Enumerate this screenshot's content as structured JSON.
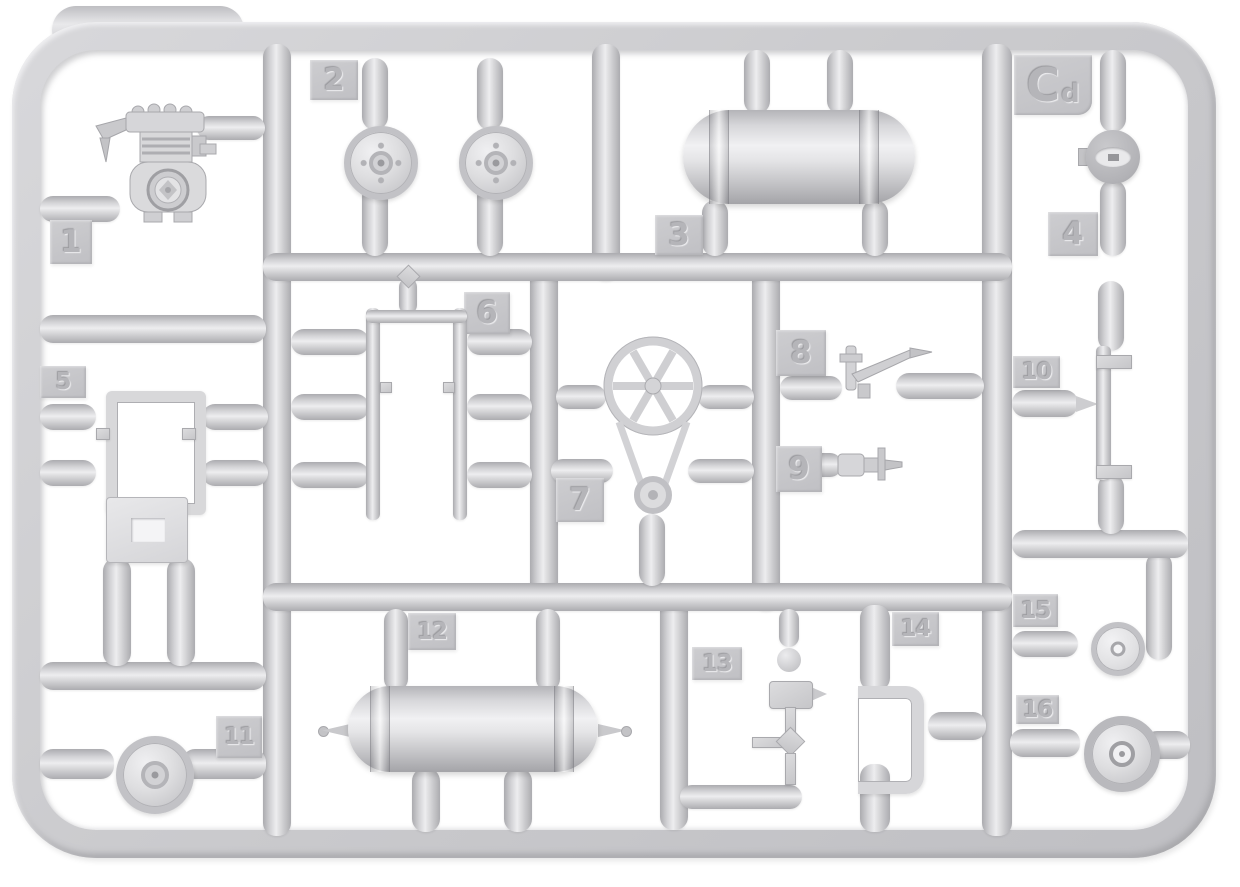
{
  "sprue": {
    "code": {
      "main": "C",
      "sub": "d"
    },
    "colors": {
      "plastic": "#c9c9cc",
      "plastic_light": "#ececee",
      "plastic_dark": "#aaaaae",
      "background": "#ffffff"
    },
    "parts": [
      {
        "number": "1",
        "shape": "air-compressor"
      },
      {
        "number": "2",
        "shape": "round-hatch-wheel-pair"
      },
      {
        "number": "3",
        "shape": "cylindrical-air-tank"
      },
      {
        "number": "4",
        "shape": "headlight"
      },
      {
        "number": "5",
        "shape": "mount-bracket-and-plate"
      },
      {
        "number": "6",
        "shape": "ladder-frame"
      },
      {
        "number": "7",
        "shape": "fan-wheel-with-belt-pulley"
      },
      {
        "number": "8",
        "shape": "valve-with-lever"
      },
      {
        "number": "9",
        "shape": "small-valve"
      },
      {
        "number": "10",
        "shape": "z-bracket"
      },
      {
        "number": "11",
        "shape": "pulley-wheel"
      },
      {
        "number": "12",
        "shape": "tank-with-axle-tips"
      },
      {
        "number": "13",
        "shape": "valve-pipe-assembly"
      },
      {
        "number": "14",
        "shape": "u-channel-bracket"
      },
      {
        "number": "15",
        "shape": "small-pulley"
      },
      {
        "number": "16",
        "shape": "flanged-wheel"
      }
    ]
  }
}
